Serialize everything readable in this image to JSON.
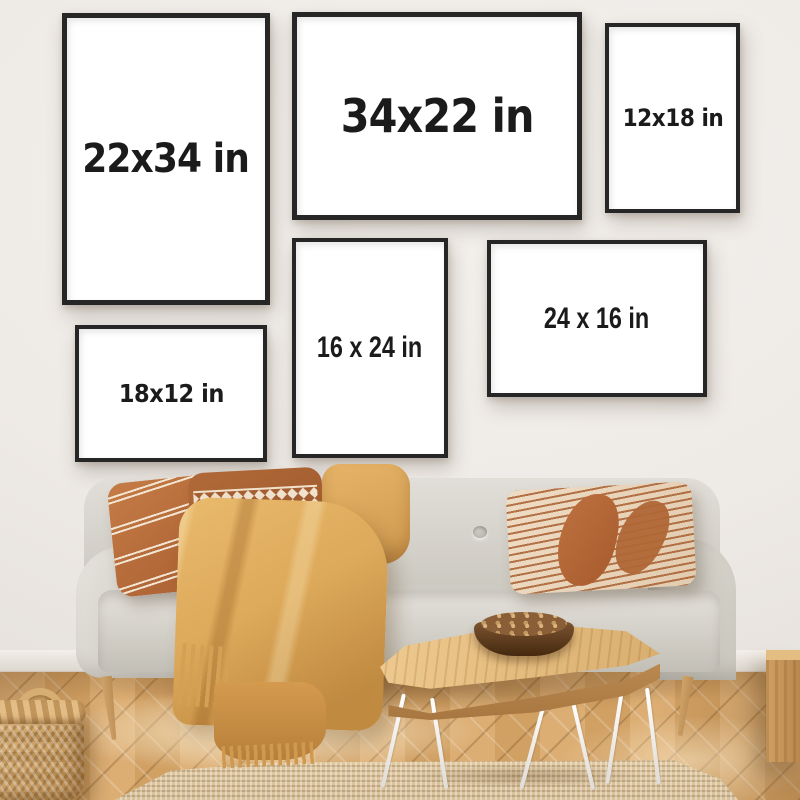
{
  "frames": [
    {
      "label": "22x34 in"
    },
    {
      "label": "34x22 in"
    },
    {
      "label": "12x18 in"
    },
    {
      "label": "16 x 24 in"
    },
    {
      "label": "24 x 16 in"
    },
    {
      "label": "18x12 in"
    }
  ],
  "colors": {
    "frame": "#262626",
    "canvas": "#ffffff",
    "label_text": "#1b1b1b",
    "wall": "#efebe7",
    "sofa": "#d8d5ce",
    "blanket": "#dda95a",
    "pillow_rust": "#b06636",
    "floor": "#d3a369",
    "rug": "#d8c09a"
  }
}
